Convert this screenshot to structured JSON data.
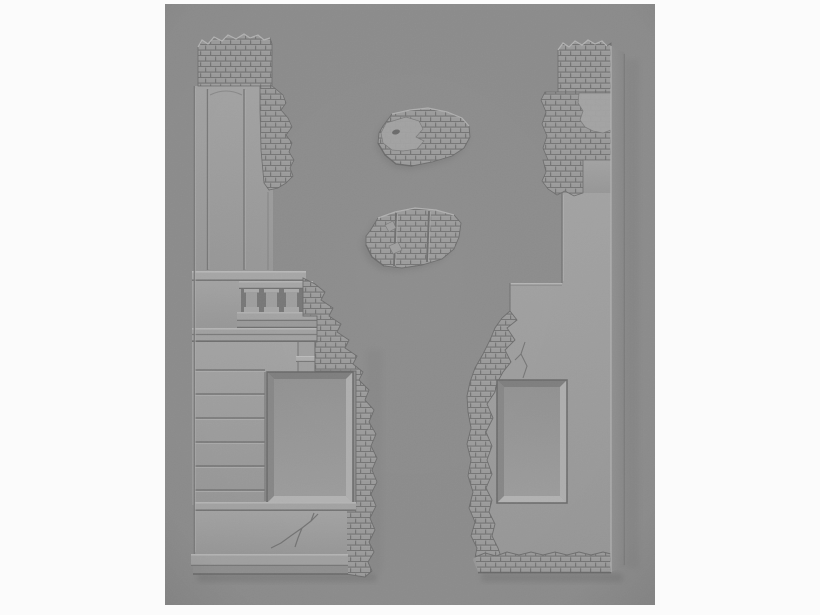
{
  "meta": {
    "type": "photograph",
    "alt": "Grey resin miniature terrain: two tall ruined building wall sections with window openings flanking two small brick rubble fragments, photographed on a grey background"
  },
  "colors": {
    "page_bg": "#fbfbfb",
    "photo_bg": "#8d8d8d",
    "piece_face_light": "#a4a4a4",
    "piece_face_dark": "#989898",
    "brick_base": "#9c9c9c",
    "mortar": "#757575",
    "highlight": "#bcbcbc",
    "deep_shadow": "#6a6a6a",
    "side_face": "#888888",
    "window_interior": "#939393"
  },
  "objects": [
    {
      "id": "left-wall-piece",
      "label": "Left ruined wall section with brick top, pilaster panel, balustrade, ashlar courses, window opening and plinth"
    },
    {
      "id": "rubble-fragment-upper",
      "label": "Small brick rubble fragment with smooth plaster patch and bullet hole"
    },
    {
      "id": "rubble-fragment-lower",
      "label": "Small brick rubble fragment with two vertical panel grooves"
    },
    {
      "id": "right-wall-piece",
      "label": "Right ruined wall section with notch, exposed brick edge, window opening and brick base"
    }
  ]
}
